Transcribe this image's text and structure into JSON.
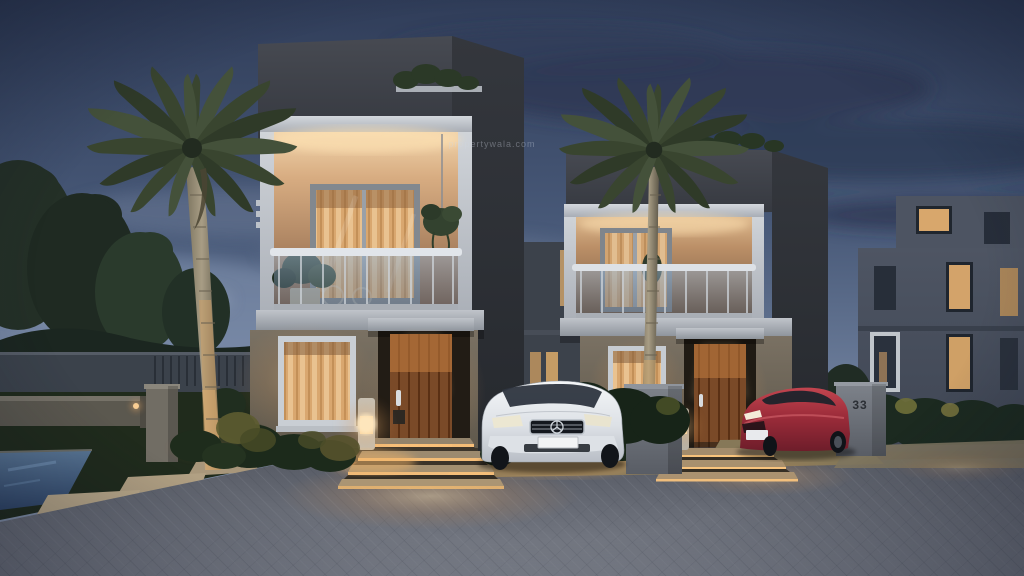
{
  "scene": {
    "description": "Photorealistic dusk rendering of a modern gated-community street: two identical two-storey duplex villas with warmly lit balconies and entrances, tall palm trees, a white sedan and a red sedan parked in driveways, landscaped garden path with a small water feature on the left, and a grey paver road in the foreground.",
    "setting": "residential street at dusk",
    "time_of_day": "dusk",
    "watermark": "propertywala.com",
    "house_numbers": {
      "middle_villa": "34",
      "right_building": "33"
    },
    "objects": [
      "dusk sky with clouds",
      "deciduous trees and boundary fence (left)",
      "tall palm tree (left)",
      "tall palm tree (center-right)",
      "front villa: lit balcony with glass railing, curtained windows, wooden front door, lit steps, bollard light",
      "second villa (plot 34): same design, red sedan in driveway",
      "third building (plot 33) at right with lit windows and hedge",
      "white sedan parked in front driveway",
      "gate pillar numbered 34",
      "gate pillar numbered 33",
      "garden path with stepping stones, low wall and water feature",
      "grey interlocking paver road with warm light pools"
    ]
  },
  "palette": {
    "sky_top": "#303d59",
    "sky_horizon": "#93a1b7",
    "cloud_dark": "#2b3752",
    "fascia_dark": "#41454c",
    "side_wall": "#2e3136",
    "warm_light": "#ffd9a0",
    "balcony_wall_lit": "#d8ad82",
    "lower_wall_beige": "#7a7163",
    "door_wood": "#7a4a28",
    "white_trim": "#d3d7dc",
    "glass_balustrade": "#8fa3b8",
    "palm_foliage": "#39452f",
    "palm_trunk": "#a89d85",
    "grass_dark": "#202b1c",
    "road_paver": "#7d818b",
    "pool_water": "#5a7796",
    "white_car": "#e8ebee",
    "red_car": "#9c2c3a"
  }
}
